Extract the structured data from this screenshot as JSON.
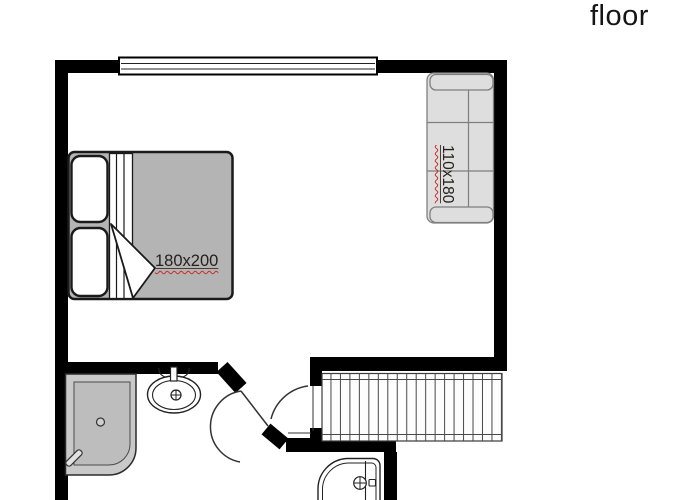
{
  "header": {
    "title": "floor"
  },
  "plan": {
    "furniture": {
      "bed": {
        "name": "double-bed",
        "size_label": "180x200"
      },
      "sofa": {
        "name": "sofa",
        "size_label": "110x180"
      }
    },
    "fixtures": [
      "window",
      "bathroom-door",
      "entry-door",
      "stairs",
      "shower",
      "sink",
      "toilet"
    ],
    "colors": {
      "wall": "#000000",
      "bed_fill": "#b4b4b4",
      "pillow_fill": "#ffffff",
      "sofa_fill": "#dedede",
      "sofa_stroke": "#7f7f7f",
      "shower_fill": "#c9c9c9",
      "shower_inner_fill": "#bdbdbd",
      "stairs_line": "#4a4a4a",
      "fixture_stroke": "#222222",
      "label_text": "#26211c",
      "label_underline_wavy": "#cc2a2a",
      "title_text": "#151515"
    }
  }
}
